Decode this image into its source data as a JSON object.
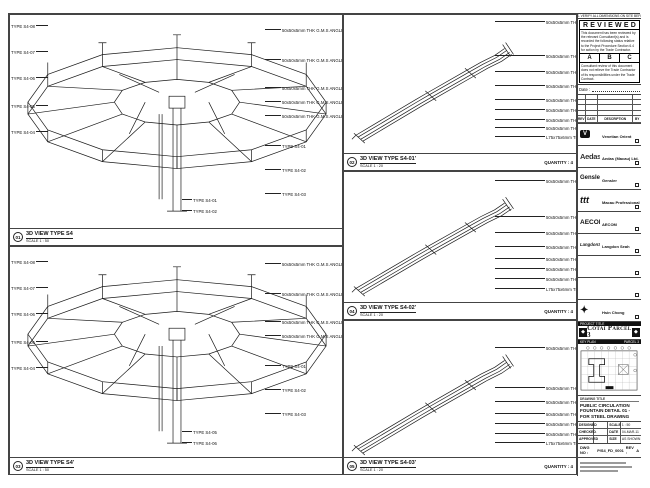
{
  "sheet_note": "DO NOT SCALE DRAWINGS. VERIFY ALL DIMENSIONS ON SITE BEFORE COMMENCING WORK.",
  "colors": {
    "ink": "#1a1a1a",
    "paper": "#ffffff",
    "banner": "#111111"
  },
  "panels": {
    "p1": {
      "num": "01",
      "title": "3D VIEW TYPE S4",
      "scale": "SCALE 1 : 50",
      "left_labels": [
        {
          "t": "TYPE S4-08",
          "y": 10
        },
        {
          "t": "TYPE S4-07",
          "y": 36
        },
        {
          "t": "TYPE S4-06",
          "y": 62
        },
        {
          "t": "TYPE S4-05",
          "y": 90
        },
        {
          "t": "TYPE S4-04",
          "y": 116
        }
      ],
      "right_labels": [
        {
          "t": "50x50x5mm THK G.M.S ANGLES",
          "y": 14
        },
        {
          "t": "50x50x5mm THK G.M.S ANGLES",
          "y": 44
        },
        {
          "t": "50x50x5mm THK G.M.S ANGLES",
          "y": 72
        },
        {
          "t": "50x50x5mm THK G.M.S ANGLES",
          "y": 86
        },
        {
          "t": "50x50x5mm THK G.M.S ANGLES",
          "y": 100
        },
        {
          "t": "TYPE S4-01",
          "y": 130
        },
        {
          "t": "TYPE S4-02",
          "y": 154
        },
        {
          "t": "TYPE S4-03",
          "y": 178
        }
      ],
      "bottom_labels": [
        {
          "t": "TYPE S4-01",
          "y": 0
        },
        {
          "t": "TYPE S4-02",
          "y": 11
        }
      ]
    },
    "p3": {
      "num": "03",
      "title": "3D VIEW TYPE S4'",
      "scale": "SCALE 1 : 50",
      "left_labels": [
        {
          "t": "TYPE S4-08",
          "y": 14
        },
        {
          "t": "TYPE S4-07",
          "y": 40
        },
        {
          "t": "TYPE S4-06",
          "y": 66
        },
        {
          "t": "TYPE S4-05",
          "y": 94
        },
        {
          "t": "TYPE S4-04",
          "y": 120
        }
      ],
      "right_labels": [
        {
          "t": "50x50x5mm THK G.M.S ANGLES",
          "y": 16
        },
        {
          "t": "50x50x5mm THK G.M.S ANGLES",
          "y": 46
        },
        {
          "t": "50x50x5mm THK G.M.S ANGLES",
          "y": 74
        },
        {
          "t": "50x50x5mm THK G.M.S ANGLES",
          "y": 88
        },
        {
          "t": "TYPE S4-01",
          "y": 118
        },
        {
          "t": "TYPE S4-02",
          "y": 142
        },
        {
          "t": "TYPE S4-03",
          "y": 166
        }
      ],
      "bottom_labels": [
        {
          "t": "TYPE S4-05",
          "y": 0
        },
        {
          "t": "TYPE S4-06",
          "y": 11
        }
      ]
    },
    "p2": {
      "num": "02",
      "title": "3D VIEW TYPE S4-01'",
      "scale": "SCALE 1 : 20",
      "quantity": "QUANTITY : 4",
      "labels": [
        {
          "t": "50x50x5mm THK G.M.S ANGLES",
          "y": 6
        },
        {
          "t": "50x50x5mm THK G.M.S ANGLES",
          "y": 40
        },
        {
          "t": "50x50x5mm THK G.M.S ANGLES",
          "y": 56
        },
        {
          "t": "50x50x5mm THK G.M.S ANGLES",
          "y": 70
        },
        {
          "t": "50x50x5mm THK G.M.S ANGLES",
          "y": 84
        },
        {
          "t": "50x50x5mm THK G.M.S ANGLES",
          "y": 94
        },
        {
          "t": "50x50x5mm THK G.M.S ANGLES",
          "y": 104
        },
        {
          "t": "50x50x5mm THK G.M.S ANGLES",
          "y": 112
        },
        {
          "t": "L75x75x6mm THK G.M.S ANGLES",
          "y": 121
        }
      ]
    },
    "p4": {
      "num": "04",
      "title": "3D VIEW TYPE S4-02'",
      "scale": "SCALE 1 : 20",
      "quantity": "QUANTITY : 4",
      "labels": [
        {
          "t": "50x50x5mm THK G.M.S ANGLES",
          "y": 8
        },
        {
          "t": "50x50x5mm THK G.M.S ANGLES",
          "y": 44
        },
        {
          "t": "50x50x5mm THK G.M.S ANGLES",
          "y": 60
        },
        {
          "t": "50x50x5mm THK G.M.S ANGLES",
          "y": 74
        },
        {
          "t": "50x50x5mm THK G.M.S ANGLES",
          "y": 86
        },
        {
          "t": "50x50x5mm THK G.M.S ANGLES",
          "y": 96
        },
        {
          "t": "50x50x5mm THK G.M.S ANGLES",
          "y": 106
        },
        {
          "t": "L75x75x6mm THK G.M.S ANGLES",
          "y": 116
        }
      ]
    },
    "p5": {
      "num": "05",
      "title": "3D VIEW TYPE S4-03'",
      "scale": "SCALE 1 : 20",
      "quantity": "QUANTITY : 4",
      "labels": [
        {
          "t": "50x50x5mm THK G.M.S ANGLES",
          "y": 26
        },
        {
          "t": "50x50x5mm THK G.M.S ANGLES",
          "y": 66
        },
        {
          "t": "50x50x5mm THK G.M.S ANGLES",
          "y": 80
        },
        {
          "t": "50x50x5mm THK G.M.S ANGLES",
          "y": 92
        },
        {
          "t": "50x50x5mm THK G.M.S ANGLES",
          "y": 102
        },
        {
          "t": "50x50x5mm THK G.M.S ANGLES",
          "y": 112
        },
        {
          "t": "L75x75x6mm THK G.M.S ANGLES",
          "y": 121
        }
      ]
    }
  },
  "stamp": {
    "title": "REVIEWED",
    "para1": "This document has been reviewed by the relevant Consultant(s) and is recorded the following status relative to the Project Procedure Section 6.4 for action by the Trade Contractor.",
    "statuses": [
      "A",
      "B",
      "C"
    ],
    "para2": "Consultant review of this document does not relieve the Trade Contractor of its responsibilities under the Trade Contract.",
    "date_label": "Date :"
  },
  "revision_table": {
    "headers": [
      "REV",
      "DATE",
      "DESCRIPTION",
      "BY"
    ]
  },
  "parties": [
    {
      "logo": "V",
      "name": "Venetian Orient Limited"
    },
    {
      "logo": "Aedas",
      "name": "Aedas (Macau) Ltd."
    },
    {
      "logo": "Gensler",
      "name": "Gensler"
    },
    {
      "logo": "ttt",
      "name": "Macau Professional Services Ltd."
    },
    {
      "logo": "AECOM",
      "name": "AECOM"
    },
    {
      "logo": "LangdonSeah",
      "name": "Langdon Seah"
    },
    {
      "logo": "",
      "name": ""
    },
    {
      "logo": "",
      "name": ""
    },
    {
      "logo": "✦",
      "name": "Hsin Chong Construction (Macau) Co., Ltd."
    }
  ],
  "project": {
    "banner": "PROJECT TITLE",
    "name": "Cotai Parcel 3",
    "keyplan_left": "KEY PLAN",
    "keyplan_right": "PARCEL 3"
  },
  "titleblock": {
    "title_label": "DRAWING TITLE",
    "line1": "PUBLIC CIRCULATION",
    "line2": "FOUNTAIN DETAIL 01 -",
    "line3": "FOR STEEL DRAWING",
    "fields": [
      {
        "label": "DESIGNED",
        "value": "-",
        "label2": "SCALE",
        "value2": "1 : 50"
      },
      {
        "label": "CHECKED",
        "value": "-",
        "label2": "DATE",
        "value2": "04-MAR-11"
      },
      {
        "label": "APPROVED",
        "value": "-",
        "label2": "SIZE",
        "value2": "AS SHOWN"
      }
    ],
    "dwg_label": "DWG NO :",
    "dwg_no": "P/S4_FD_0001",
    "rev_label": "REV :",
    "rev": "A"
  }
}
